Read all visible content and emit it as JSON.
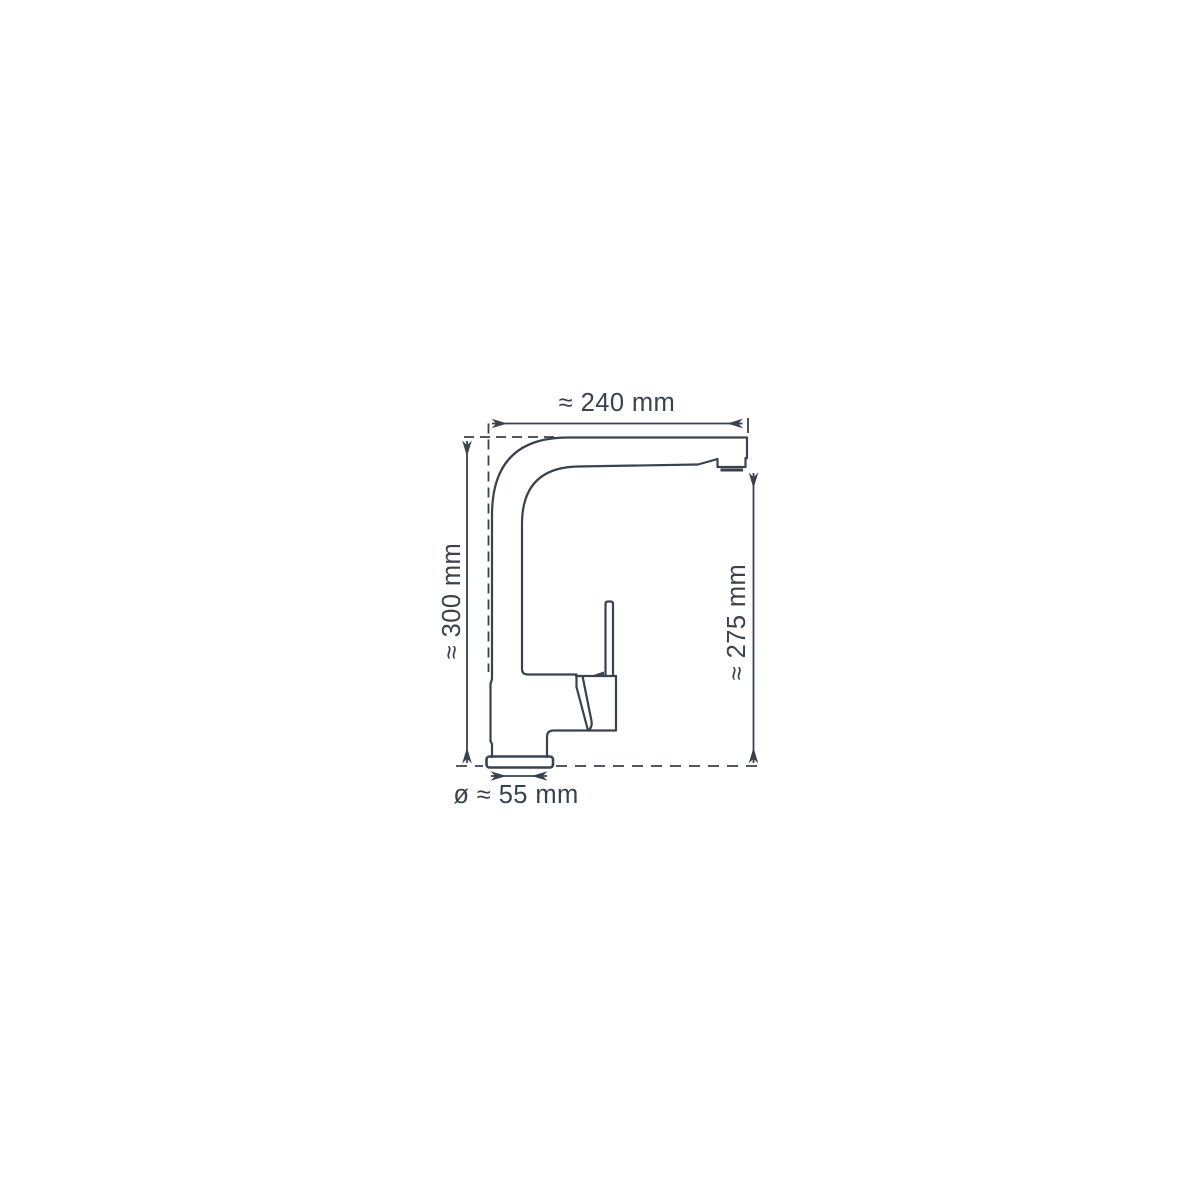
{
  "diagram": {
    "background": "#ffffff",
    "line_color": "#3a424e",
    "dimensions": {
      "spout_reach": "≈ 240 mm",
      "total_height": "≈ 300 mm",
      "outlet_height": "≈ 275 mm",
      "base_diameter": "ø ≈ 55 mm"
    }
  }
}
